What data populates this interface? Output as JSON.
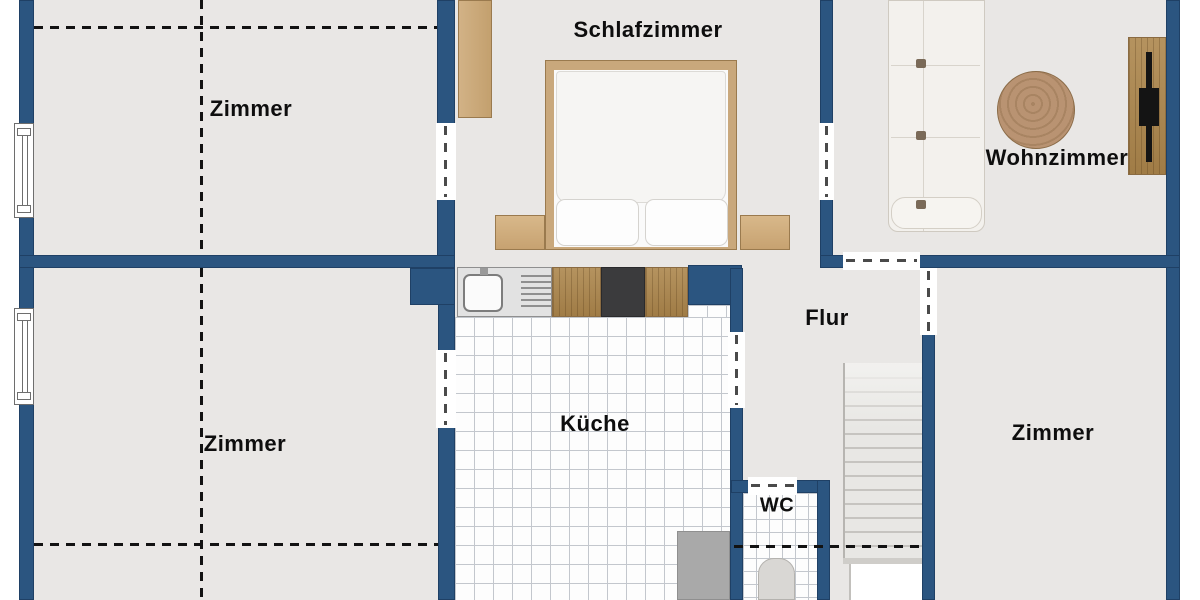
{
  "plan_title": "apartment-floor-plan",
  "rooms": [
    {
      "id": "zimmer-top-left",
      "label": "Zimmer"
    },
    {
      "id": "schlafzimmer",
      "label": "Schlafzimmer"
    },
    {
      "id": "wohnzimmer",
      "label": "Wohnzimmer"
    },
    {
      "id": "zimmer-bottom-left",
      "label": "Zimmer"
    },
    {
      "id": "kueche",
      "label": "Küche"
    },
    {
      "id": "flur",
      "label": "Flur"
    },
    {
      "id": "wc",
      "label": "WC"
    },
    {
      "id": "zimmer-right",
      "label": "Zimmer"
    }
  ],
  "colors": {
    "wall": "#2b5580",
    "floor": "#e9e7e5",
    "tile_floor": "#fdfdfd",
    "tile_line": "#c3c7cd",
    "wood_furniture": "#c9a87c",
    "wood_counter": "#a8854f",
    "counter_unit": "#e2e2e2",
    "stove": "#3b3b3d",
    "appliance_gray": "#a9a9a9",
    "stair": "#e8e7e4",
    "sofa": "#f3f1ed",
    "dashed_line": "#121212",
    "outside": "#ffffff"
  },
  "symbols": [
    "window-symbol",
    "door-opening",
    "staircase",
    "toilet",
    "sink",
    "stove"
  ]
}
